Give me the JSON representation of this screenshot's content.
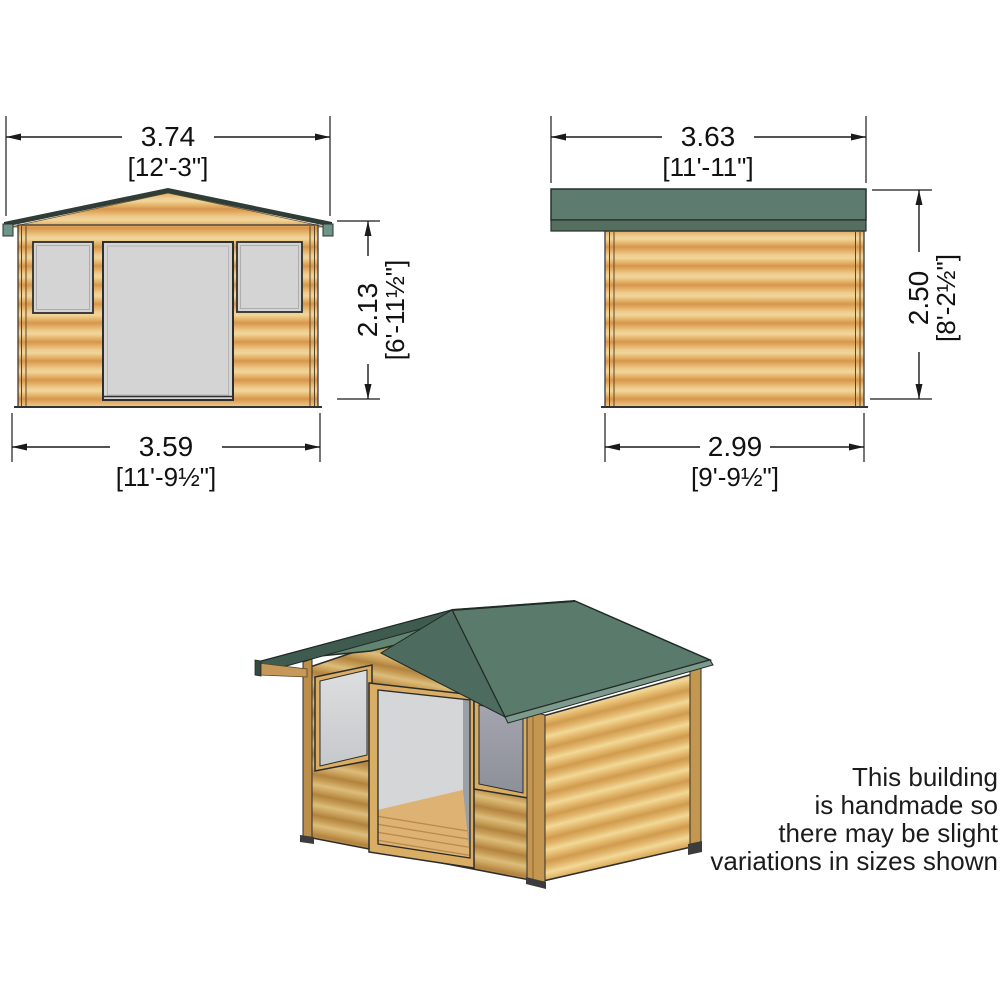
{
  "front_view": {
    "width": {
      "metric": "3.74",
      "imperial": "[12'-3\"]"
    },
    "height": {
      "metric": "2.13",
      "imperial": "[6'-11½\"]"
    },
    "base_width": {
      "metric": "3.59",
      "imperial": "[11'-9½\"]"
    }
  },
  "side_view": {
    "width": {
      "metric": "3.63",
      "imperial": "[11'-11\"]"
    },
    "height": {
      "metric": "2.50",
      "imperial": "[8'-2½\"]"
    },
    "base_width": {
      "metric": "2.99",
      "imperial": "[9'-9½\"]"
    }
  },
  "note": {
    "lines": [
      "This building",
      "is handmade so",
      "there may be slight",
      "variations in sizes shown"
    ]
  },
  "colors": {
    "roof_green": "#5d7b6e",
    "roof_green_dark": "#3f5b4f",
    "roof_edge_light": "#7e9a8c",
    "eave_tab_teal": "#6f9589",
    "wood_light": "#f0d59a",
    "wood_dark": "#d6964e",
    "window_grey": "#d4d4d4",
    "window_grey_dark": "#979aa4",
    "line": "#1a1a1a"
  }
}
